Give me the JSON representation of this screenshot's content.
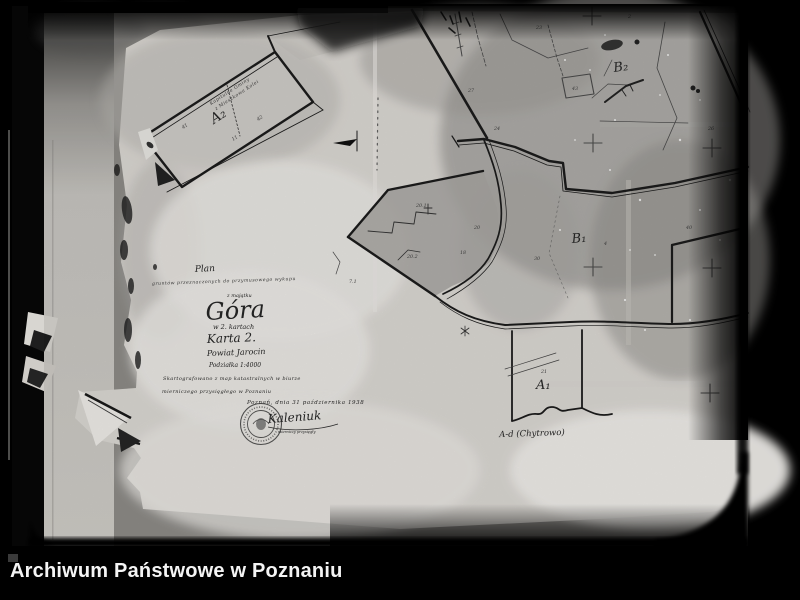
{
  "footer": {
    "archive_name": "Archiwum Państwowe w Poznaniu"
  },
  "map": {
    "title_block": {
      "line1": "Plan",
      "line2": "gruntów przeznaczonych do przymusowego wykupu",
      "line3": "z majątku",
      "estate_name": "Góra",
      "line5": "w 2. kartach",
      "sheet": "Karta 2.",
      "district": "Powiat Jarocin",
      "scale": "Podziałka 1:4000",
      "note1": "Skartografowano z map katastralnych w biurze",
      "note2": "mierniczego przysięgłego w Poznaniu",
      "dateline": "Poznań, dnia 31 października 1938",
      "signature": "Kaleniuk",
      "signature_title": "mierniczy przysięgły"
    },
    "strip_parcel": {
      "label_line1": "Kapitulne Gminy",
      "label_line2": "z Mieszkowa Kolei",
      "id": "A₂",
      "num1": "41",
      "num2": "42",
      "num3": "11"
    },
    "parcel_ids": {
      "b1": "B₁",
      "b2": "B₂",
      "a1": "A₁"
    },
    "caption": "A-d (Chytrowo)",
    "plot_numbers": [
      {
        "t": "27"
      },
      {
        "t": "43"
      },
      {
        "t": "23"
      },
      {
        "t": "2"
      },
      {
        "t": "20"
      },
      {
        "t": "24"
      },
      {
        "t": "18"
      },
      {
        "t": "30"
      },
      {
        "t": "21"
      },
      {
        "t": "40"
      },
      {
        "t": "4"
      },
      {
        "t": "26"
      },
      {
        "t": "7.1"
      },
      {
        "t": "20.1"
      },
      {
        "t": "20.2"
      }
    ],
    "colors": {
      "paper": "#dcd9d4",
      "ink": "#1c1c1c",
      "frame": "#000000"
    }
  }
}
